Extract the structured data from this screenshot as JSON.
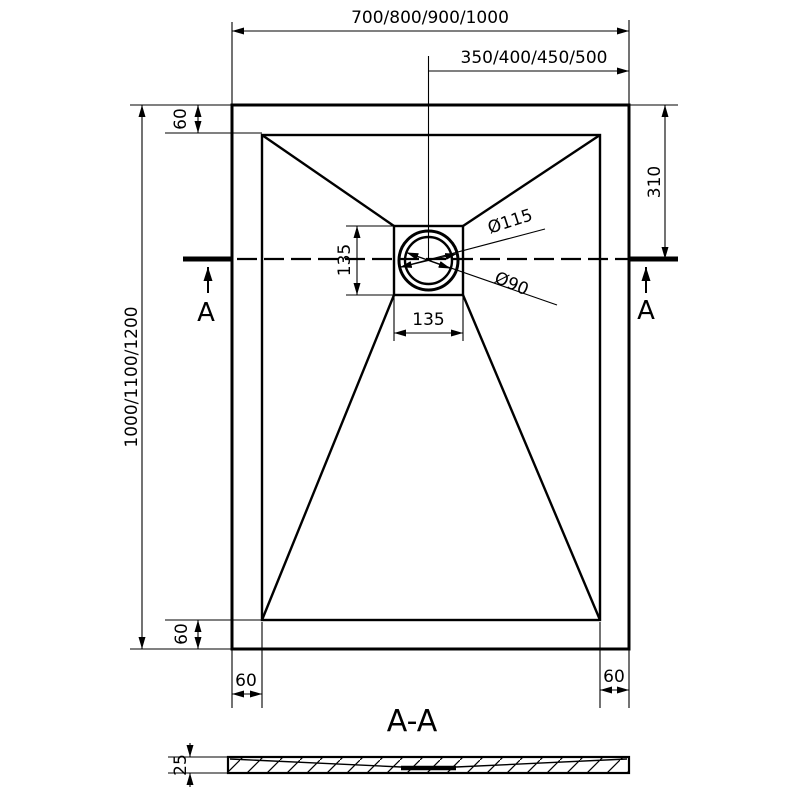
{
  "plan": {
    "dim_width_series": "700/800/900/1000",
    "dim_center_series": "350/400/450/500",
    "dim_length_series": "1000/1100/1200",
    "dim_rim_top": "60",
    "dim_rim_bottom": "60",
    "dim_rim_left": "60",
    "dim_rim_right": "60",
    "dim_drain_offset_top": "310",
    "dim_drain_square_height": "135",
    "dim_drain_square_width": "135",
    "dim_drain_flange_diameter": "Ø115",
    "dim_drain_waste_diameter": "Ø90",
    "cut_label_left": "A",
    "cut_label_right": "A"
  },
  "section": {
    "title": "A-A",
    "dim_thickness": "25"
  },
  "colors": {
    "line": "#000000",
    "background": "#ffffff"
  }
}
